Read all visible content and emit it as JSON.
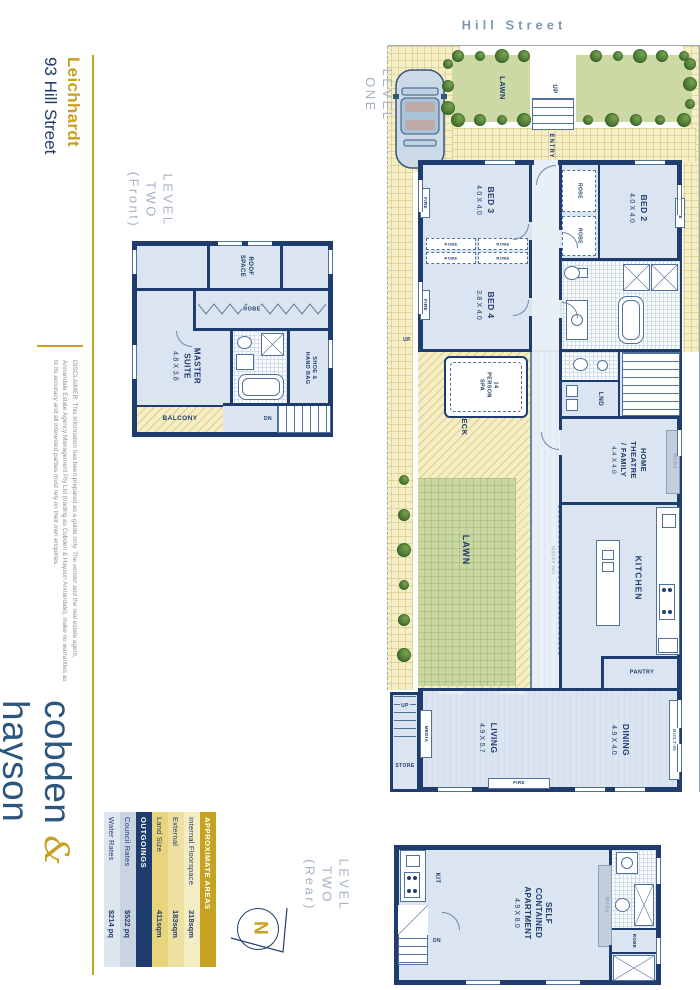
{
  "street": "Hill Street",
  "title": {
    "suburb": "Leichhardt",
    "address": "93 Hill Street"
  },
  "levels": {
    "one": "LEVEL\nONE",
    "two_front": "LEVEL\nTWO\n(Front)",
    "two_rear": "LEVEL\nTWO\n(Rear)"
  },
  "rooms": {
    "bed2": {
      "name": "BED 2",
      "dim": "4.0 X 4.0"
    },
    "bed3": {
      "name": "BED 3",
      "dim": "4.0 X 4.0"
    },
    "bed4": {
      "name": "BED 4",
      "dim": "3.8 X 4.0"
    },
    "master": {
      "name": "MASTER\nSUITE",
      "dim": "4.8 X 3.8"
    },
    "theatre": {
      "name": "HOME\nTHEATRE\n/ FAMILY",
      "dim": "4.4 X 4.0"
    },
    "living": {
      "name": "LIVING",
      "dim": "4.9 X 5.7"
    },
    "dining": {
      "name": "DINING",
      "dim": "4.9 X 4.0"
    },
    "apartment": {
      "name": "SELF\nCONTAINED\nAPARTMENT",
      "dim": "4.9 X 8.0"
    },
    "kitchen": "KITCHEN",
    "spa": "14\nPERSON\nSPA",
    "roof_space": "ROOF\nSPACE",
    "shoe": "SHOE &\nHAND BAG",
    "lawn": "LAWN",
    "deck": "DECK",
    "balcony": "BALCONY"
  },
  "labels": {
    "entry": "ENTRY",
    "up": "UP",
    "dn": "DN",
    "robe": "ROBE",
    "fire": "FIRE",
    "lnd": "LND",
    "pantry": "PANTRY",
    "store": "STORE",
    "media": "MEDIA",
    "media_small": "Media",
    "built_in": "BUILT-IN",
    "kit": "KIT",
    "highlite": "Highlite Win",
    "north": "N"
  },
  "tables": {
    "areas": {
      "header": "APPROXIMATE AREAS",
      "rows": [
        {
          "label": "Internal Floorspace",
          "value": "318sqm"
        },
        {
          "label": "External",
          "value": "183sqm"
        },
        {
          "label": "Land Size",
          "value": "411sqm"
        }
      ]
    },
    "outgoings": {
      "header": "OUTGOINGS",
      "rows": [
        {
          "label": "Council Rates",
          "value": "$522 pq"
        },
        {
          "label": "Water Rates",
          "value": "$214 pq"
        }
      ]
    }
  },
  "footer": {
    "disclaimer": "DISCLAIMER: This information has been prepared as a guide only. The vendor and the real estate agent, Annandale Estate Agency Management Pty Ltd (trading as Cobden & Hayson Annandale), make no warranties as to its accuracy and all interested parties must rely on their own enquiries.",
    "logo": {
      "left": "cobden",
      "amp": "&",
      "right": "hayson"
    }
  },
  "colors": {
    "navy": "#1e3c6e",
    "gold": "#c7a221",
    "floor": "#dbe5f1",
    "lawn": "#cbd9a4",
    "paving": "#f6efc6"
  }
}
